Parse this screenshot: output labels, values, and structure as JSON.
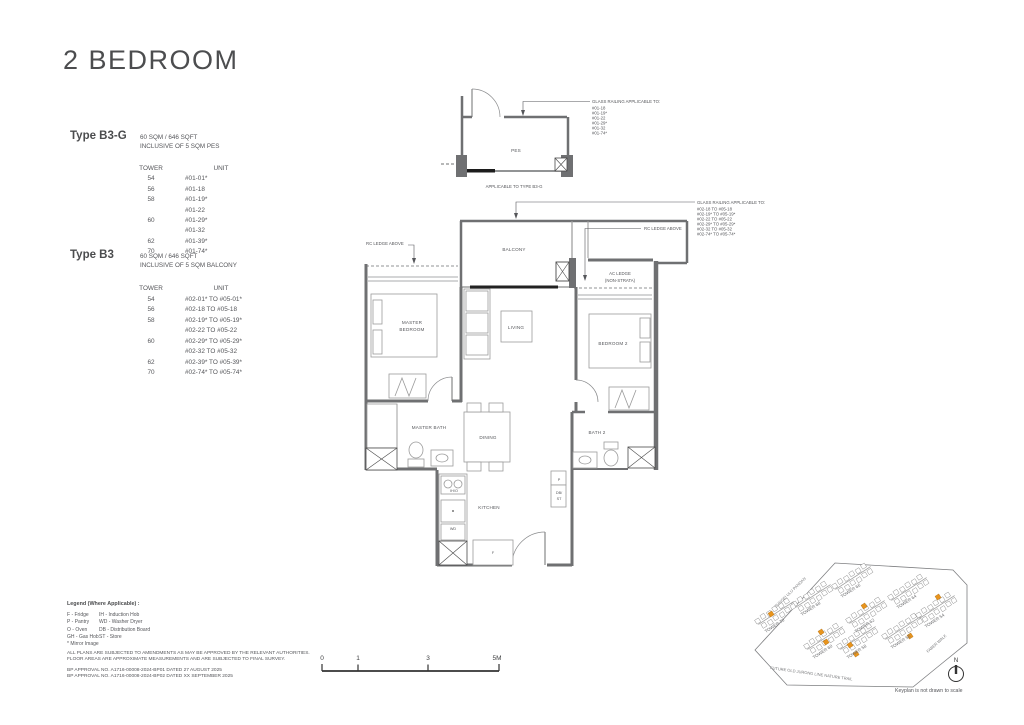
{
  "title": "2 BEDROOM",
  "types": [
    {
      "name": "Type B3-G",
      "area": "60 SQM / 646 SQFT",
      "inclusive": "INCLUSIVE OF 5 SQM PES",
      "table": {
        "headers": [
          "TOWER",
          "UNIT"
        ],
        "rows": [
          [
            "54",
            "#01-01*"
          ],
          [
            "56",
            "#01-18"
          ],
          [
            "58",
            "#01-19*"
          ],
          [
            "",
            "#01-22"
          ],
          [
            "60",
            "#01-29*"
          ],
          [
            "",
            "#01-32"
          ],
          [
            "62",
            "#01-39*"
          ],
          [
            "70",
            "#01-74*"
          ]
        ]
      }
    },
    {
      "name": "Type B3",
      "area": "60 SQM / 646 SQFT",
      "inclusive": "INCLUSIVE OF 5 SQM BALCONY",
      "table": {
        "headers": [
          "TOWER",
          "UNIT"
        ],
        "rows": [
          [
            "54",
            "#02-01* TO #05-01*"
          ],
          [
            "56",
            "#02-18 TO #05-18"
          ],
          [
            "58",
            "#02-19* TO #05-19*"
          ],
          [
            "",
            "#02-22 TO #05-22"
          ],
          [
            "60",
            "#02-29* TO #05-29*"
          ],
          [
            "",
            "#02-32 TO #05-32"
          ],
          [
            "62",
            "#02-39* TO #05-39*"
          ],
          [
            "70",
            "#02-74* TO #05-74*"
          ]
        ]
      }
    }
  ],
  "plan": {
    "rooms": {
      "pes": "PES",
      "balcony": "BALCONY",
      "living": "LIVING",
      "master_bedroom": [
        "MASTER",
        "BEDROOM"
      ],
      "bedroom2": "BEDROOM 2",
      "master_bath": "MASTER BATH",
      "dining": "DINING",
      "bath2": "BATH 2",
      "kitchen": "KITCHEN"
    },
    "fixtures": {
      "ih_o": "IH/O",
      "wd": "WD",
      "f": "F",
      "p": "P",
      "db": [
        "DB/",
        "ST"
      ]
    },
    "annotations": {
      "glass_railing_g": {
        "title": "GLASS RAILING APPLICABLE TO:",
        "units": [
          "#01-18",
          "#01-19*",
          "#01-22",
          "#01-29*",
          "#01-32",
          "#01-74*"
        ]
      },
      "glass_railing_b3": {
        "title": "GLASS RAILING APPLICABLE TO:",
        "units": [
          "#02-18 TO #05-18",
          "#02-19* TO #05-19*",
          "#02-22 TO #05-22",
          "#02-29* TO #05-29*",
          "#02-32 TO #05-32",
          "#02-74* TO #05-74*"
        ]
      },
      "applicable_to": "APPLICABLE TO TYPE B3-G",
      "rc_ledge_left": "RC LEDGE ABOVE",
      "rc_ledge_right": "RC LEDGE ABOVE",
      "ac_ledge": [
        "AC LEDGE",
        "(NON-STRATA)"
      ]
    }
  },
  "legend": {
    "title": "Legend (Where Applicable) :",
    "col1": [
      "F - Fridge",
      "P - Pantry",
      "O - Oven",
      "GH - Gas Hob",
      "* Mirror Image"
    ],
    "col2": [
      "IH - Induction Hob",
      "WD - Washer Dryer",
      "DB - Distribution Board",
      "ST - Store"
    ],
    "disclaimer1": "ALL PLANS ARE SUBJECTED TO AMENDMENTS AS MAY BE APPROVED BY THE RELEVANT AUTHORITIES.",
    "disclaimer2": "FLOOR AREAS ARE APPROXIMATE MEASUREMENTS AND ARE SUBJECTED TO FINAL SURVEY.",
    "bp1": "BP APPROVAL NO. A1716-00008-2024-BP01  DATED 27 AUGUST 2025",
    "bp2": "BP APPROVAL NO. A1716-00008-2024-BP02  DATED XX SEPTEMBER 2025"
  },
  "scalebar": {
    "labels": [
      "0",
      "1",
      "3",
      "5M"
    ]
  },
  "keyplan": {
    "towers": [
      "TOWER 66",
      "TOWER 68",
      "TOWER 70",
      "TOWER 64",
      "TOWER 62",
      "TOWER 60",
      "TOWER 54",
      "TOWER 56",
      "TOWER 58"
    ],
    "roads": [
      "SUNGEI ULU PANDAN",
      "FUTURE OLD JURONG LINE NATURE TRAIL",
      "FABER WALK"
    ],
    "note": "Keyplan is not drawn to scale",
    "north_label": "N",
    "highlight_color": "#E8941C"
  },
  "colors": {
    "wall": "#6f7072",
    "text": "#55565a",
    "highlight": "#E8941C"
  }
}
